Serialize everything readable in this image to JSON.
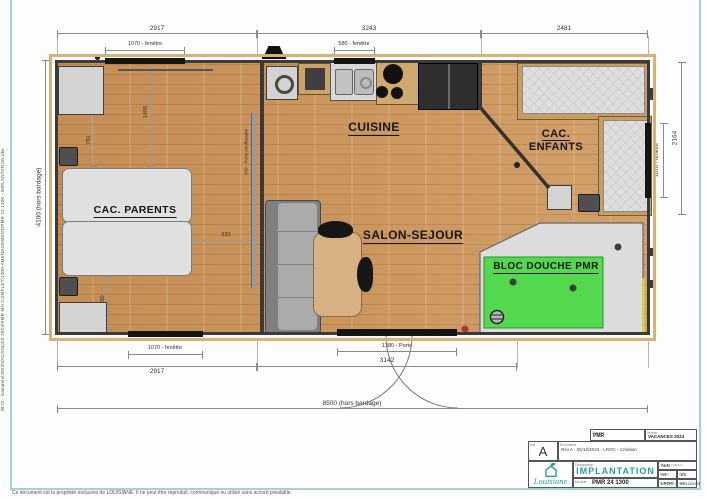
{
  "page": {
    "footer": "Ce document est la propriété exclusive de LOUISIANE. Il ne peut être reproduit, communiqué ou utilisé sans accord préalable.",
    "side_path": "W:\\3 - Gammes\\2023\\VACANCES 2023\\PMR MH COMPLET\\1300-AMENAGEMENT\\PMR 23 1300 - IMPLANTATION.idw"
  },
  "rooms": {
    "parents": "CAC. PARENTS",
    "cuisine": "CUISINE",
    "salon": "SALON-SEJOUR",
    "enfants_line1": "CAC.",
    "enfants_line2": "ENFANTS",
    "douche": "BLOC DOUCHE PMR"
  },
  "dims": {
    "top_seg1": "2917",
    "top_seg2": "3243",
    "top_seg3": "2481",
    "top_win1": "1070 - fenêtre",
    "top_win2": "580 - fenêtre",
    "bot_win": "1070 - fenêtre",
    "bot_door": "1380 - Porte",
    "bot_seg1": "2917",
    "bot_seg2": "3142",
    "bot_total": "8500 (hors bardage)",
    "left_total": "4100 (hors bardage)",
    "right_total": "2164",
    "right_win": "1070 - fenêtre",
    "in_1490": "1490",
    "in_781": "781",
    "in_933": "933",
    "in_900": "900",
    "sliding": "990 - Porte coulissante"
  },
  "titleblock": {
    "gamme_label": "Gamme",
    "gamme": "PMR",
    "annee_label": "Année",
    "annee": "VACANCES 2024",
    "ind_label": "Ind.",
    "ind": "A",
    "evo_label": "Évolutions",
    "evo": "Rév.A - 05/12/2023 - LROC - Création",
    "brand": "Louisiane",
    "design_label": "Désignation",
    "title": "IMPLANTATION",
    "model_label": "Modèle",
    "model": "PMR 24 1300",
    "charge_label": "Chargé d'affaires",
    "charge": "ALN",
    "format_label": "Format",
    "format": "A3",
    "folio_label": "Folio",
    "folio": "1/1",
    "dess_label": "Dessinateur",
    "dess": "LROC",
    "date_label": "Date",
    "date": "05/12/2023"
  },
  "colors": {
    "accent": "#2b9da5",
    "douche_green": "#53d94e",
    "floor_wood": "#ca9660"
  }
}
